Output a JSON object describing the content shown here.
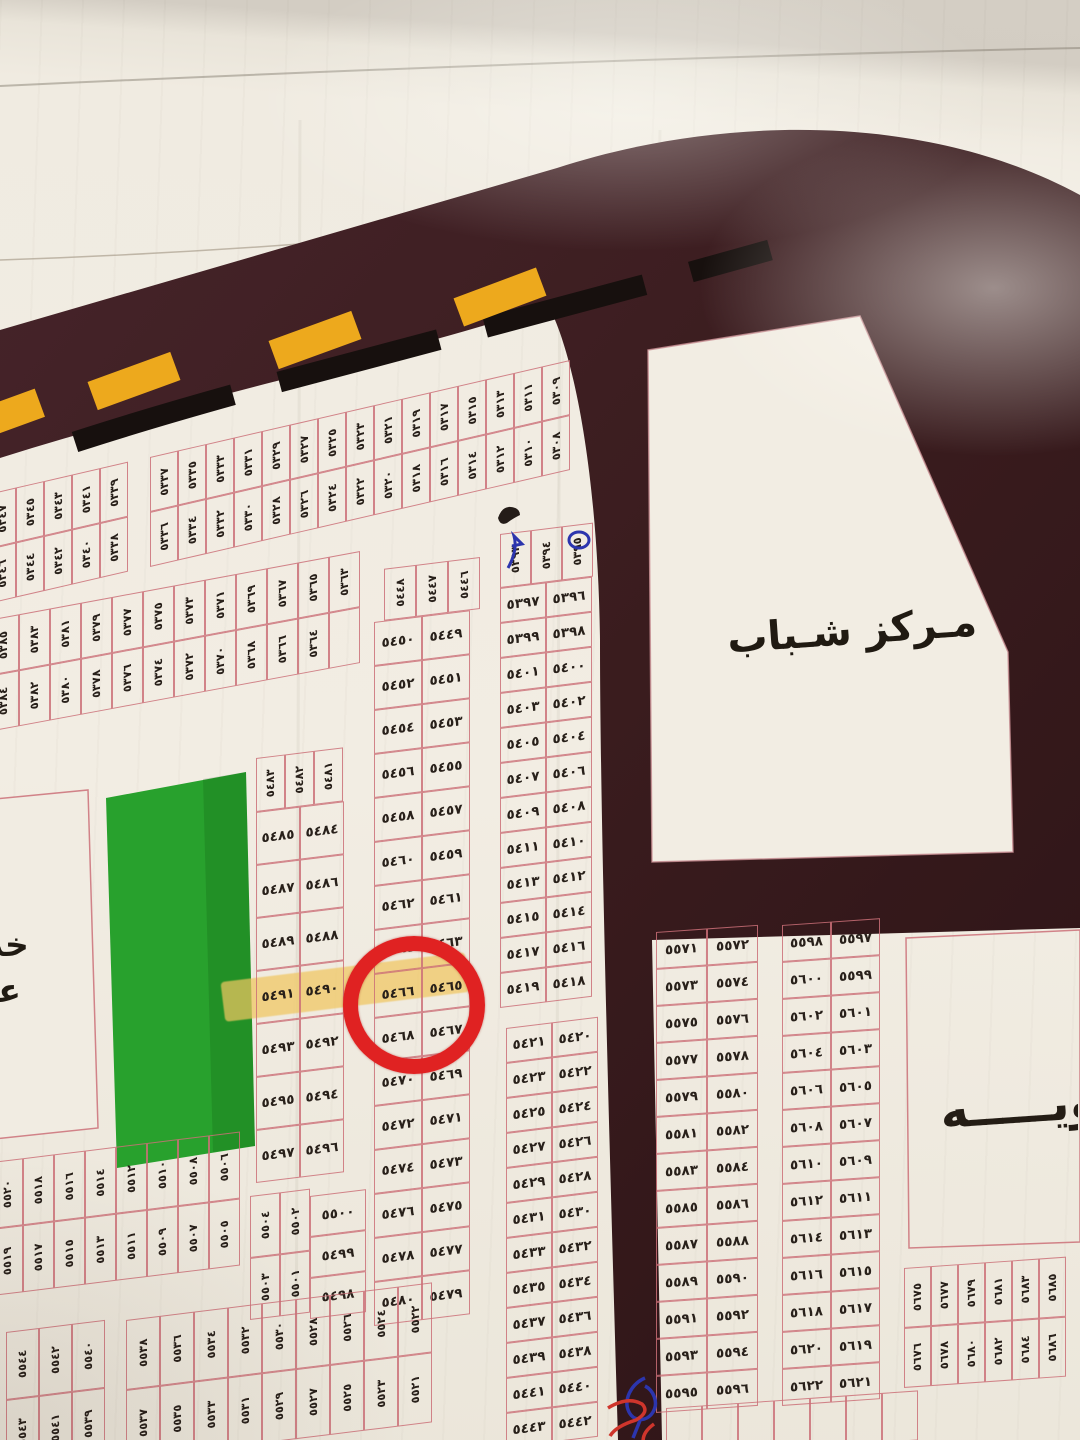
{
  "labels": {
    "youth_center": "مـركز شـباب",
    "left_edge_partial_line1": "خد",
    "left_edge_partial_line2": "عا",
    "right_edge_partial": "ـويـــــه"
  },
  "annotations": {
    "red_circled_plot": "٥٤٦٦",
    "highlighted_plots": [
      "٥٤٩١",
      "٥٤٩٠",
      "٥٤٦٦"
    ],
    "blue_pen_marked_plots": [
      "٥٣٩٣",
      "٥٣٩٥"
    ],
    "pen_mark_colors": [
      "blue",
      "red"
    ]
  },
  "colors": {
    "road": "#3a1c1e",
    "road_dark": "#2c1316",
    "paper": "#f1ece2",
    "plot_border": "rgba(203,112,120,0.85)",
    "ink": "#28201a",
    "park_green": "#28a12d",
    "lane_yellow": "#eda91d",
    "stripe_black": "#17100e",
    "circle_red": "#e02222",
    "highlight_yellow": "rgba(240,198,95,0.72)",
    "blue_pen": "#2c35ad",
    "red_pen": "#cf352c"
  },
  "map": {
    "blocks": [
      {
        "name": "band-5338-5347",
        "type": "cols",
        "x": -12,
        "y": 494,
        "angle": -13,
        "cellW": 28,
        "cellH": 55,
        "cols": [
          [
            "٥٣٤٧",
            "٥٣٤٦"
          ],
          [
            "٥٣٤٥",
            "٥٣٤٤"
          ],
          [
            "٥٣٤٣",
            "٥٣٤٢"
          ],
          [
            "٥٣٤١",
            "٥٣٤٠"
          ],
          [
            "٥٣٣٩",
            "٥٣٣٨"
          ]
        ]
      },
      {
        "name": "band-5308-5337",
        "type": "cols",
        "x": 150,
        "y": 457,
        "angle": -13,
        "cellW": 28,
        "cellH": 55,
        "cols": [
          [
            "٥٣٣٧",
            "٥٣٣٦"
          ],
          [
            "٥٣٣٥",
            "٥٣٣٤"
          ],
          [
            "٥٣٣٣",
            "٥٣٣٢"
          ],
          [
            "٥٣٣١",
            "٥٣٣٠"
          ],
          [
            "٥٣٢٩",
            "٥٣٢٨"
          ],
          [
            "٥٣٢٧",
            "٥٣٢٦"
          ],
          [
            "٥٣٢٥",
            "٥٣٢٤"
          ],
          [
            "٥٣٢٣",
            "٥٣٢٢"
          ],
          [
            "٥٣٢١",
            "٥٣٢٠"
          ],
          [
            "٥٣١٩",
            "٥٣١٨"
          ],
          [
            "٥٣١٧",
            "٥٣١٦"
          ],
          [
            "٥٣١٥",
            "٥٣١٤"
          ],
          [
            "٥٣١٣",
            "٥٣١٢"
          ],
          [
            "٥٣١١",
            "٥٣١٠"
          ],
          [
            "٥٣٠٩",
            "٥٣٠٨"
          ]
        ]
      },
      {
        "name": "band-5363-5385",
        "type": "cols",
        "x": -12,
        "y": 620,
        "angle": -10.5,
        "cellW": 31,
        "cellH": 56,
        "cols": [
          [
            "٥٣٨٥",
            "٥٣٨٤"
          ],
          [
            "٥٣٨٣",
            "٥٣٨٢"
          ],
          [
            "٥٣٨١",
            "٥٣٨٠"
          ],
          [
            "٥٣٧٩",
            "٥٣٧٨"
          ],
          [
            "٥٣٧٧",
            "٥٣٧٦"
          ],
          [
            "٥٣٧٥",
            "٥٣٧٤"
          ],
          [
            "٥٣٧٣",
            "٥٣٧٢"
          ],
          [
            "٥٣٧١",
            "٥٣٧٠"
          ],
          [
            "٥٣٦٩",
            "٥٣٦٨"
          ],
          [
            "٥٣٦٧",
            "٥٣٦٦"
          ],
          [
            "٥٣٦٥",
            "٥٣٦٤"
          ],
          [
            "٥٣٦٣",
            ""
          ]
        ]
      },
      {
        "name": "block-5481-5497",
        "type": "rows",
        "x": 256,
        "y": 758,
        "angle": -7,
        "cellW": 44,
        "cellH": 53,
        "header": [
          "٥٤٨٣",
          "٥٤٨٢",
          "٥٤٨١"
        ],
        "headerW": 29,
        "headerH": 54,
        "headerDx": 0,
        "rows": [
          [
            "٥٤٨٥",
            "٥٤٨٤"
          ],
          [
            "٥٤٨٧",
            "٥٤٨٦"
          ],
          [
            "٥٤٨٩",
            "٥٤٨٨"
          ],
          [
            "٥٤٩١",
            "٥٤٩٠"
          ],
          [
            "٥٤٩٣",
            "٥٤٩٢"
          ],
          [
            "٥٤٩٥",
            "٥٤٩٤"
          ],
          [
            "٥٤٩٧",
            "٥٤٩٦"
          ]
        ]
      },
      {
        "name": "block-5501-5504",
        "type": "cols",
        "x": 250,
        "y": 1196,
        "angle": -7,
        "cellW": 30,
        "cellH": 62,
        "cols": [
          [
            "٥٥٠٤",
            "٥٥٠٣"
          ],
          [
            "٥٥٠٢",
            "٥٥٠١"
          ]
        ]
      },
      {
        "name": "block-5498-5500",
        "type": "rows",
        "x": 310,
        "y": 1196,
        "angle": -7,
        "cellW": 56,
        "cellH": 41,
        "rows": [
          [
            "٥٥٠٠"
          ],
          [
            "٥٤٩٩"
          ],
          [
            "٥٤٩٨"
          ]
        ]
      },
      {
        "name": "strip-5446-5480",
        "type": "rows",
        "x": 374,
        "y": 570,
        "angle": -7,
        "cellW": 48,
        "cellH": 44,
        "header": [
          "٥٤٤٨",
          "٥٤٤٧",
          "٥٤٤٦"
        ],
        "headerW": 32,
        "headerH": 52,
        "headerDx": 10,
        "rows": [
          [
            "٥٤٥٠",
            "٥٤٤٩"
          ],
          [
            "٥٤٥٢",
            "٥٤٥١"
          ],
          [
            "٥٤٥٤",
            "٥٤٥٣"
          ],
          [
            "٥٤٥٦",
            "٥٤٥٥"
          ],
          [
            "٥٤٥٨",
            "٥٤٥٧"
          ],
          [
            "٥٤٦٠",
            "٥٤٥٩"
          ],
          [
            "٥٤٦٢",
            "٥٤٦١"
          ],
          [
            "٥٤٦٤",
            "٥٤٦٣"
          ],
          [
            "٥٤٦٦",
            "٥٤٦٥"
          ],
          [
            "٥٤٦٨",
            "٥٤٦٧"
          ],
          [
            "٥٤٧٠",
            "٥٤٦٩"
          ],
          [
            "٥٤٧٢",
            "٥٤٧١"
          ],
          [
            "٥٤٧٤",
            "٥٤٧٣"
          ],
          [
            "٥٤٧٦",
            "٥٤٧٥"
          ],
          [
            "٥٤٧٨",
            "٥٤٧٧"
          ],
          [
            "٥٤٨٠",
            "٥٤٧٩"
          ]
        ]
      },
      {
        "name": "strip-5393-5419",
        "type": "rows",
        "x": 500,
        "y": 534,
        "angle": -7,
        "cellW": 46,
        "cellH": 35,
        "header": [
          "٥٣٩٣",
          "٥٣٩٤",
          "٥٣٩٥"
        ],
        "headerW": 31,
        "headerH": 54,
        "headerDx": 0,
        "rows": [
          [
            "٥٣٩٧",
            "٥٣٩٦"
          ],
          [
            "٥٣٩٩",
            "٥٣٩٨"
          ],
          [
            "٥٤٠١",
            "٥٤٠٠"
          ],
          [
            "٥٤٠٣",
            "٥٤٠٢"
          ],
          [
            "٥٤٠٥",
            "٥٤٠٤"
          ],
          [
            "٥٤٠٧",
            "٥٤٠٦"
          ],
          [
            "٥٤٠٩",
            "٥٤٠٨"
          ],
          [
            "٥٤١١",
            "٥٤١٠"
          ],
          [
            "٥٤١٣",
            "٥٤١٢"
          ],
          [
            "٥٤١٥",
            "٥٤١٤"
          ],
          [
            "٥٤١٧",
            "٥٤١٦"
          ],
          [
            "٥٤١٩",
            "٥٤١٨"
          ]
        ]
      },
      {
        "name": "strip-5420-5443",
        "type": "rows",
        "x": 506,
        "y": 1028,
        "angle": -7,
        "cellW": 46,
        "cellH": 35,
        "rows": [
          [
            "٥٤٢١",
            "٥٤٢٠"
          ],
          [
            "٥٤٢٣",
            "٥٤٢٢"
          ],
          [
            "٥٤٢٥",
            "٥٤٢٤"
          ],
          [
            "٥٤٢٧",
            "٥٤٢٦"
          ],
          [
            "٥٤٢٩",
            "٥٤٢٨"
          ],
          [
            "٥٤٣١",
            "٥٤٣٠"
          ],
          [
            "٥٤٣٣",
            "٥٤٣٢"
          ],
          [
            "٥٤٣٥",
            "٥٤٣٤"
          ],
          [
            "٥٤٣٧",
            "٥٤٣٦"
          ],
          [
            "٥٤٣٩",
            "٥٤٣٨"
          ],
          [
            "٥٤٤١",
            "٥٤٤٠"
          ],
          [
            "٥٤٤٣",
            "٥٤٤٢"
          ]
        ]
      },
      {
        "name": "band-5505-5520",
        "type": "cols",
        "x": -8,
        "y": 1162,
        "angle": -7,
        "cellW": 31,
        "cellH": 67,
        "cols": [
          [
            "٥٥٢٠",
            "٥٥١٩"
          ],
          [
            "٥٥١٨",
            "٥٥١٧"
          ],
          [
            "٥٥١٦",
            "٥٥١٥"
          ],
          [
            "٥٥١٤",
            "٥٥١٣"
          ],
          [
            "٥٥١٢",
            "٥٥١١"
          ],
          [
            "٥٥١٠",
            "٥٥٠٩"
          ],
          [
            "٥٥٠٨",
            "٥٥٠٧"
          ],
          [
            "٥٥٠٦",
            "٥٥٠٥"
          ]
        ]
      },
      {
        "name": "band-5539-5544",
        "type": "cols",
        "x": 6,
        "y": 1332,
        "angle": -7,
        "cellW": 33,
        "cellH": 68,
        "cols": [
          [
            "٥٥٤٤",
            "٥٥٤٣"
          ],
          [
            "٥٥٤٢",
            "٥٥٤١"
          ],
          [
            "٥٥٤٠",
            "٥٥٣٩"
          ]
        ]
      },
      {
        "name": "band-5521-5538",
        "type": "cols",
        "x": 126,
        "y": 1320,
        "angle": -7,
        "cellW": 34,
        "cellH": 70,
        "cols": [
          [
            "٥٥٣٨",
            "٥٥٣٧"
          ],
          [
            "٥٥٣٦",
            "٥٥٣٥"
          ],
          [
            "٥٥٣٤",
            "٥٥٣٣"
          ],
          [
            "٥٥٣٢",
            "٥٥٣١"
          ],
          [
            "٥٥٣٠",
            "٥٥٢٩"
          ],
          [
            "٥٥٢٨",
            "٥٥٢٧"
          ],
          [
            "٥٥٢٦",
            "٥٥٢٥"
          ],
          [
            "٥٥٢٤",
            "٥٥٢٣"
          ],
          [
            "٥٥٢٢",
            "٥٥٢١"
          ]
        ]
      },
      {
        "name": "block-5571-5596",
        "type": "rows",
        "x": 656,
        "y": 932,
        "angle": -4,
        "cellW": 51,
        "cellH": 37,
        "rows": [
          [
            "٥٥٧١",
            "٥٥٧٢"
          ],
          [
            "٥٥٧٣",
            "٥٥٧٤"
          ],
          [
            "٥٥٧٥",
            "٥٥٧٦"
          ],
          [
            "٥٥٧٧",
            "٥٥٧٨"
          ],
          [
            "٥٥٧٩",
            "٥٥٨٠"
          ],
          [
            "٥٥٨١",
            "٥٥٨٢"
          ],
          [
            "٥٥٨٣",
            "٥٥٨٤"
          ],
          [
            "٥٥٨٥",
            "٥٥٨٦"
          ],
          [
            "٥٥٨٧",
            "٥٥٨٨"
          ],
          [
            "٥٥٨٩",
            "٥٥٩٠"
          ],
          [
            "٥٥٩١",
            "٥٥٩٢"
          ],
          [
            "٥٥٩٣",
            "٥٥٩٤"
          ],
          [
            "٥٥٩٥",
            "٥٥٩٦"
          ]
        ]
      },
      {
        "name": "block-5597-5622",
        "type": "rows",
        "x": 782,
        "y": 925,
        "angle": -4,
        "cellW": 49,
        "cellH": 37,
        "rows": [
          [
            "٥٥٩٨",
            "٥٥٩٧"
          ],
          [
            "٥٦٠٠",
            "٥٥٩٩"
          ],
          [
            "٥٦٠٢",
            "٥٦٠١"
          ],
          [
            "٥٦٠٤",
            "٥٦٠٣"
          ],
          [
            "٥٦٠٦",
            "٥٦٠٥"
          ],
          [
            "٥٦٠٨",
            "٥٦٠٧"
          ],
          [
            "٥٦١٠",
            "٥٦٠٩"
          ],
          [
            "٥٦١٢",
            "٥٦١١"
          ],
          [
            "٥٦١٤",
            "٥٦١٣"
          ],
          [
            "٥٦١٦",
            "٥٦١٥"
          ],
          [
            "٥٦١٨",
            "٥٦١٧"
          ],
          [
            "٥٦٢٠",
            "٥٦١٩"
          ],
          [
            "٥٦٢٢",
            "٥٦٢١"
          ]
        ]
      },
      {
        "name": "block-5675-5686",
        "type": "cols",
        "x": 904,
        "y": 1268,
        "angle": -4,
        "cellW": 27,
        "cellH": 60,
        "cols": [
          [
            "٥٦٧٥",
            "٥٦٧٦"
          ],
          [
            "٥٦٧٧",
            "٥٦٧٨"
          ],
          [
            "٥٦٧٩",
            "٥٦٨٠"
          ],
          [
            "٥٦٨١",
            "٥٦٨٢"
          ],
          [
            "٥٦٨٣",
            "٥٦٨٤"
          ],
          [
            "٥٦٨٥",
            "٥٦٨٦"
          ]
        ]
      },
      {
        "name": "partial-bottom-right",
        "type": "cols",
        "x": 666,
        "y": 1408,
        "angle": -4,
        "cellW": 36,
        "cellH": 50,
        "cols": [
          [
            ""
          ],
          [
            ""
          ],
          [
            ""
          ],
          [
            ""
          ],
          [
            ""
          ],
          [
            ""
          ],
          [
            ""
          ]
        ]
      }
    ]
  }
}
